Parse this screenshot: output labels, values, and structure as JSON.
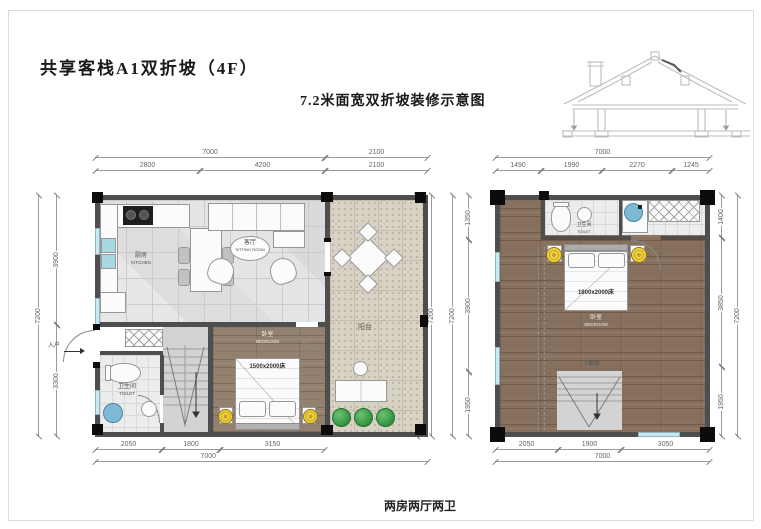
{
  "page": {
    "title": "共享客栈A1双折坡（4F）",
    "subtitle": "7.2米面宽双折坡装修示意图",
    "caption": "两房两厅两卫"
  },
  "left_plan": {
    "dims": {
      "top_total_main": "7000",
      "top_total_balcony": "2100",
      "top_segments": [
        "2800",
        "4200",
        "2100"
      ],
      "left_total": "7200",
      "left_segments": [
        "3900",
        "3300"
      ],
      "right_segments": [
        "3900",
        "1350",
        "1950"
      ],
      "right_total": "7200",
      "bottom_segments": [
        "2050",
        "1800",
        "3150"
      ],
      "bottom_total": "7000"
    },
    "labels": {
      "kitchen_cn": "厨房",
      "kitchen_en": "KITCHEN",
      "sitting_cn": "客厅",
      "sitting_en": "SITTING ROOM",
      "balcony": "阳台",
      "bedroom_cn": "卧室",
      "bedroom_en": "BEDROOM",
      "bed_size": "1500x2000床",
      "toilet_cn": "卫生间",
      "toilet_en": "TOILET",
      "entry": "入户"
    }
  },
  "right_plan": {
    "dims": {
      "top_total": "7000",
      "top_segments": [
        "1490",
        "1990",
        "2270",
        "1245"
      ],
      "left_total": "7200",
      "left_segments": [
        "1350",
        "3900",
        "1950"
      ],
      "right_segments": [
        "1400",
        "3850",
        "1950"
      ],
      "right_total": "7200",
      "bottom_segments": [
        "2050",
        "1900",
        "3050"
      ],
      "bottom_total": "7000"
    },
    "labels": {
      "toilet_cn": "卫生间",
      "toilet_en": "TOILET",
      "bedroom_cn": "卧室",
      "bedroom_en": "BEDROOM",
      "bed_size": "1800x2000床",
      "stairs_down": "下楼梯"
    }
  }
}
